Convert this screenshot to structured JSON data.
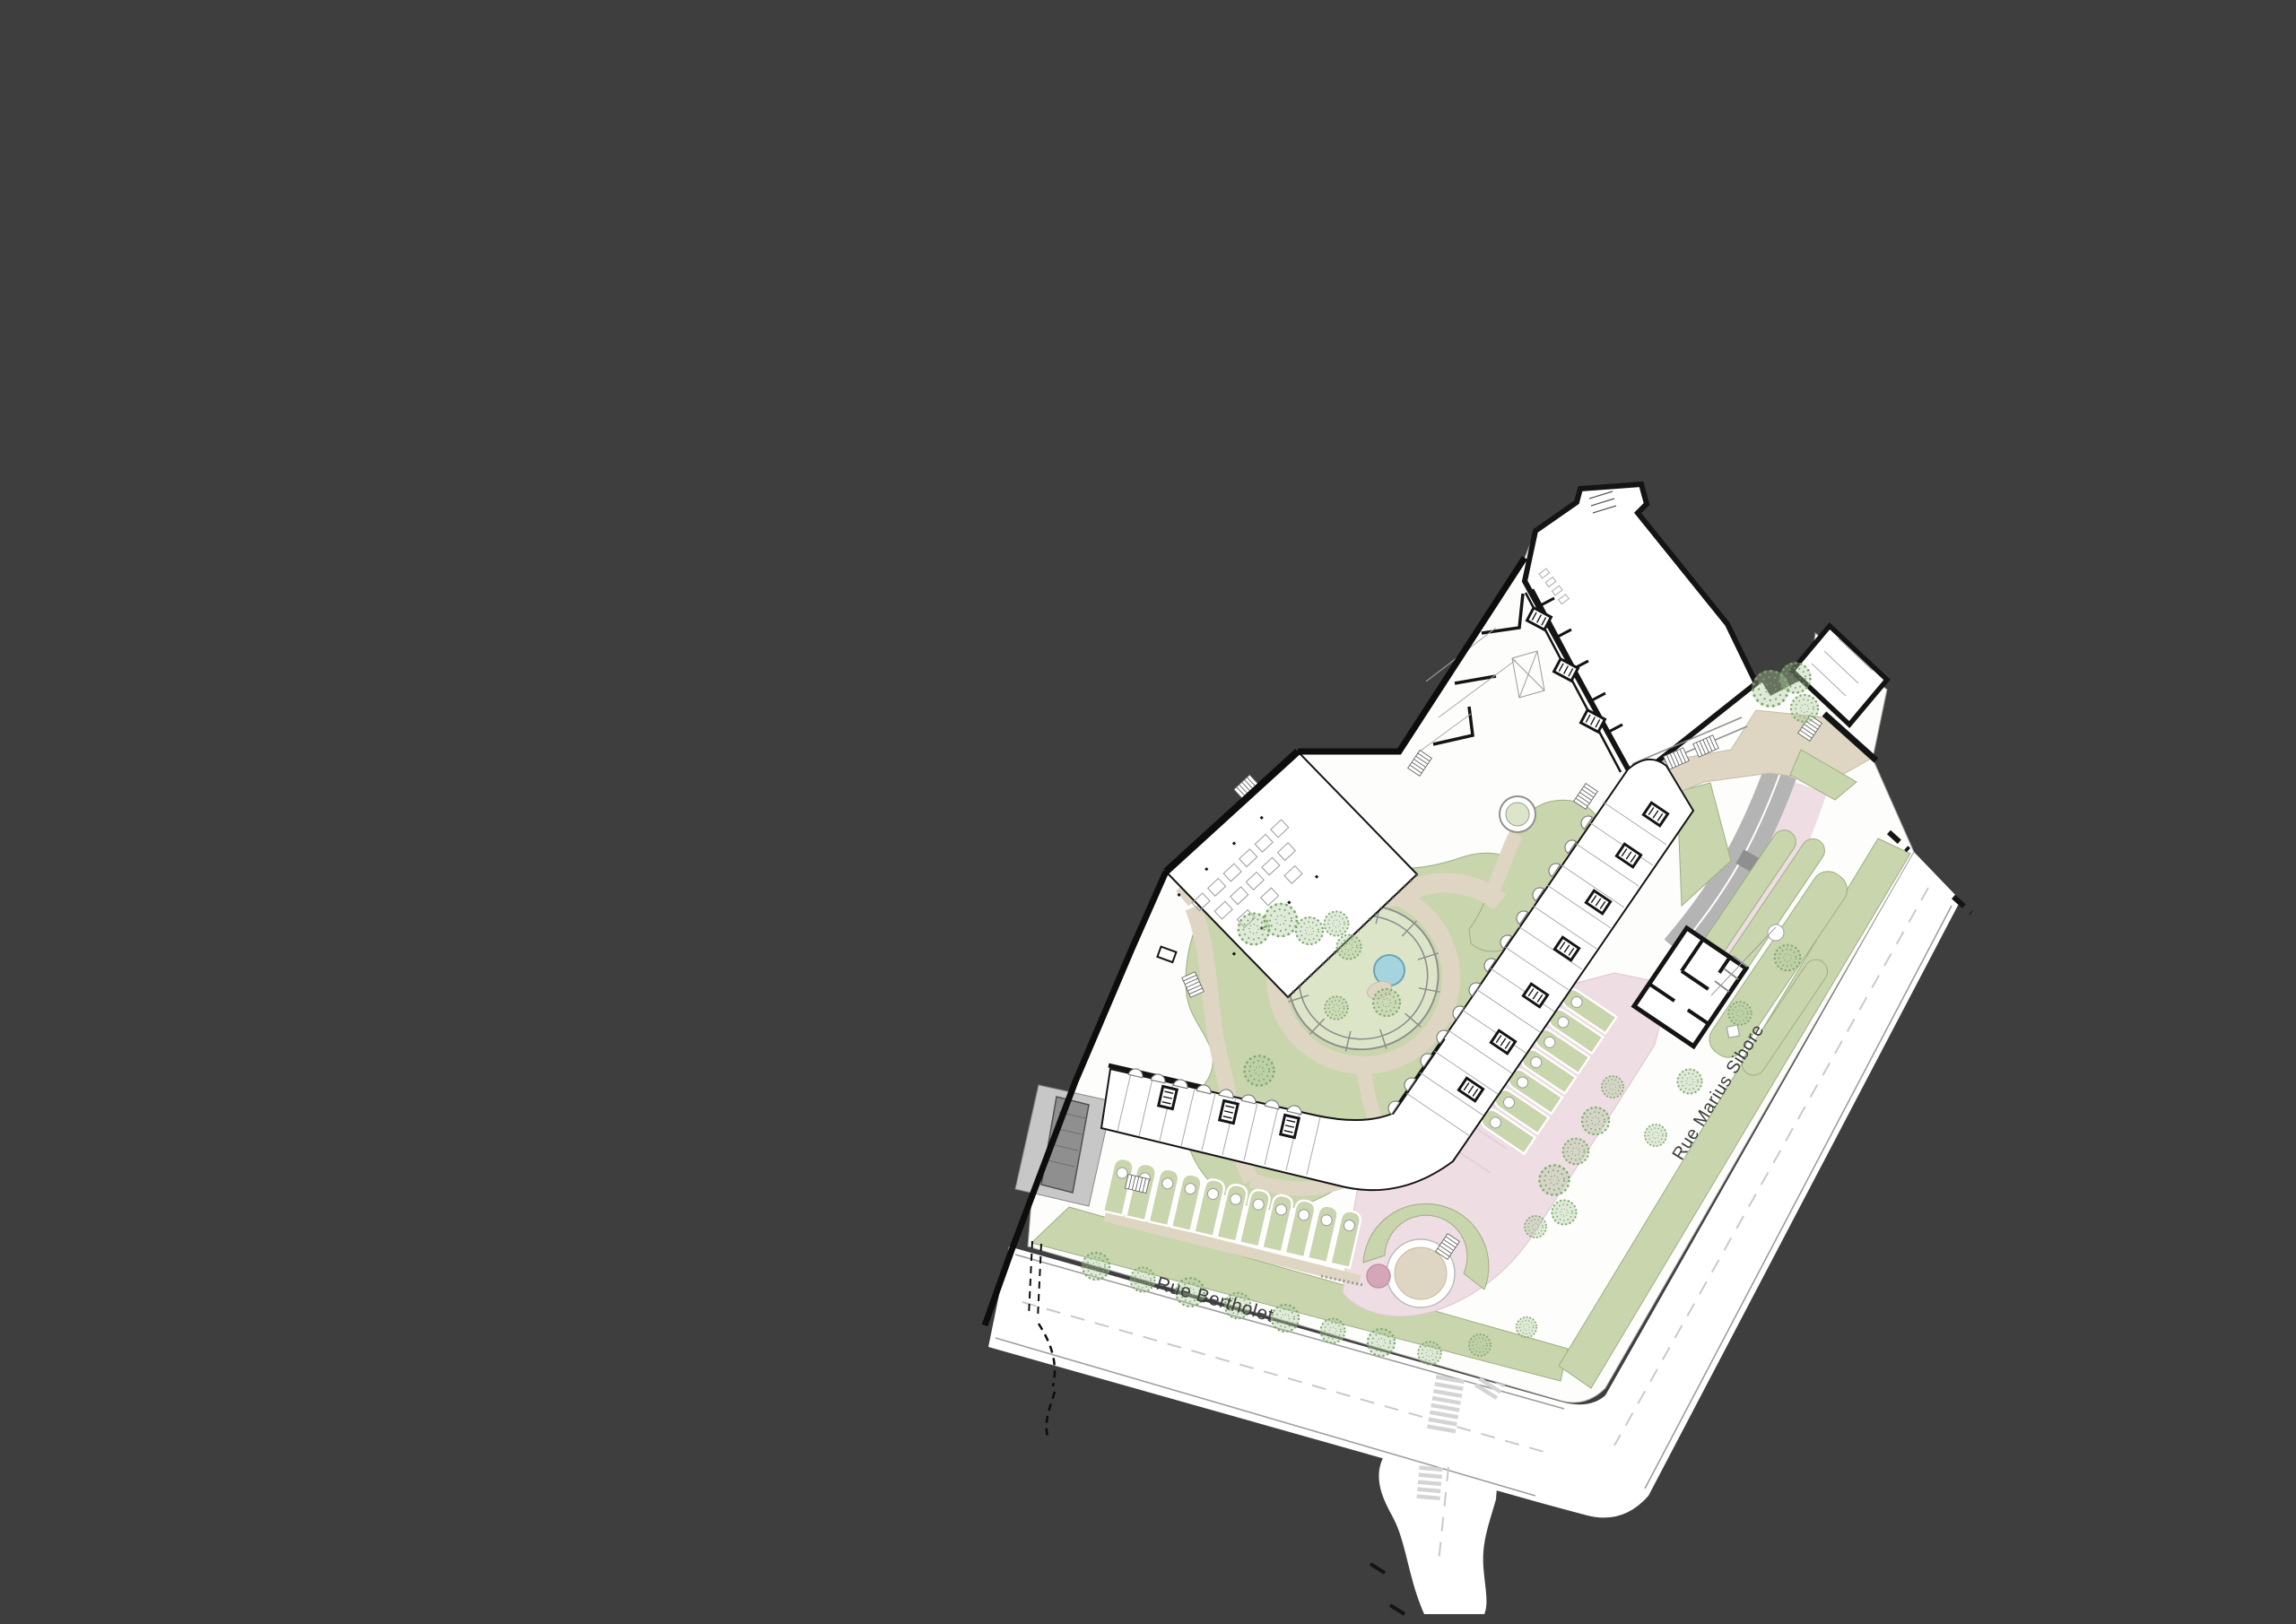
{
  "drawing_type": "architectural site plan",
  "street_labels": [
    {
      "id": "rue-bertholet",
      "text": "Rue Bertholet"
    },
    {
      "id": "rue-marius-sibore",
      "text": "Rue Marius Sibore"
    }
  ],
  "colors": {
    "background": "#3e3e3e",
    "road": "#ffffff",
    "parcel": "#fdfdfc",
    "building": "#ffffff",
    "wall": "#141414",
    "thin": "#a9a9a9",
    "curb": "#9d9d9d",
    "dashline": "#c9c9c9",
    "crosswalk": "#d4d4d4",
    "lawn": "#c9d5ad",
    "lawnLight": "#dde5c9",
    "lawnEdge": "#9fae85",
    "path": "#ded6c2",
    "pathEdge": "#c7bda4",
    "plaza": "#eedde3",
    "plazaEdge": "#ddc6d0",
    "plazaCircle": "#d5a6b8",
    "pool": "#a5d4df",
    "poolEdge": "#69a4b4",
    "ramp": "#b4b4b4",
    "rampDark": "#8f8f8f",
    "tree": "#79a569",
    "treeFill": "#aec89a",
    "labelText": "#3c3c3c"
  }
}
